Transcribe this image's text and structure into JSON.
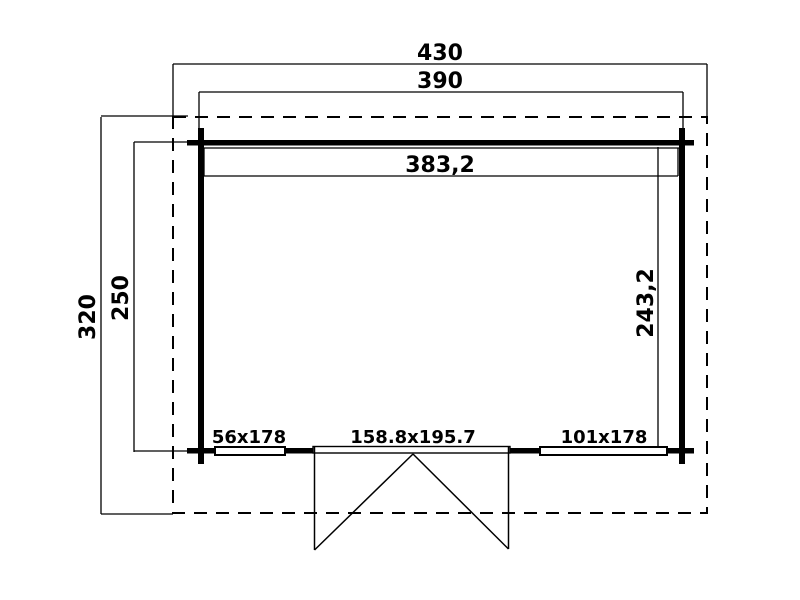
{
  "plan": {
    "dims": {
      "roof_width": "430",
      "wall_width": "390",
      "inner_width": "383,2",
      "roof_depth": "320",
      "wall_depth": "250",
      "inner_depth": "243,2"
    },
    "openings": {
      "left_window": "56x178",
      "door": "158.8x195.7",
      "right_window": "101x178"
    },
    "colors": {
      "line": "#000000",
      "background": "#ffffff"
    }
  }
}
